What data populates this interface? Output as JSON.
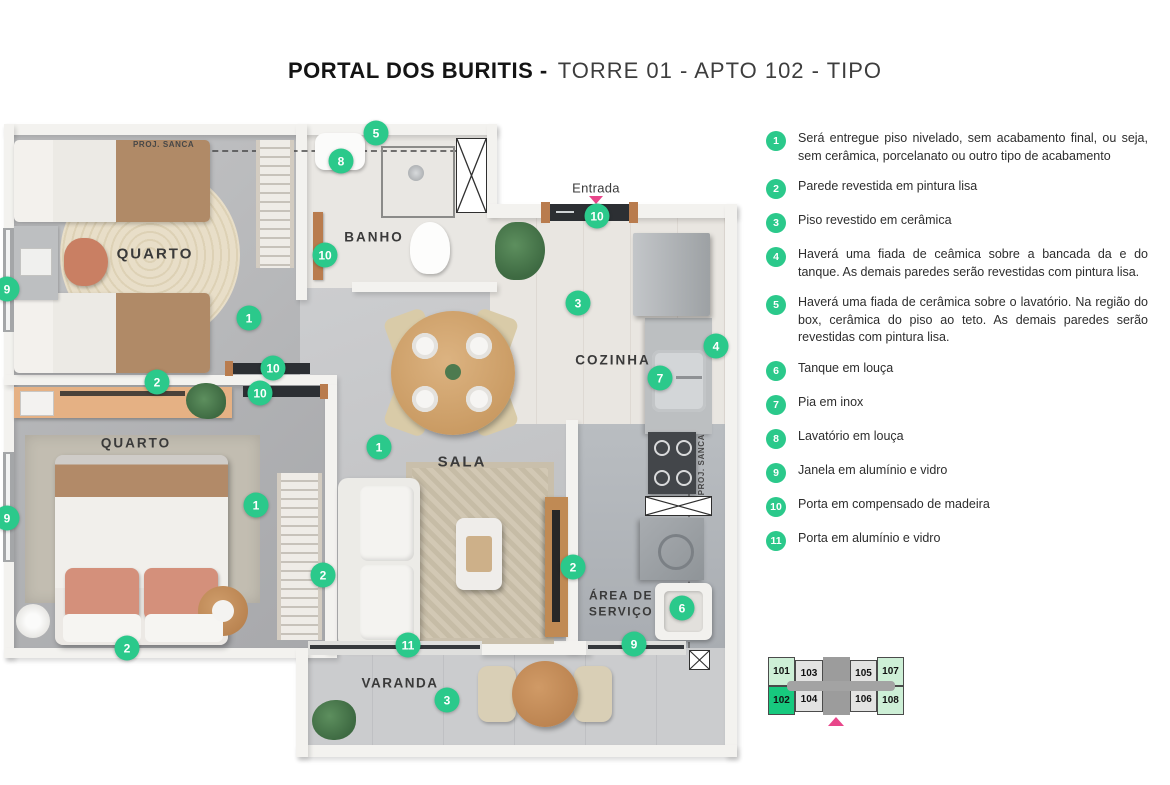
{
  "title": {
    "main": "PORTAL DOS BURITIS -",
    "sub": "TORRE 01 - APTO 102 - TIPO"
  },
  "legend": {
    "items": [
      {
        "num": "1",
        "text": "Será entregue piso nivelado, sem acabamento final, ou seja, sem cerâmica, porcelanato ou outro tipo de acabamento"
      },
      {
        "num": "2",
        "text": "Parede revestida em pintura lisa"
      },
      {
        "num": "3",
        "text": "Piso revestido em cerâmica"
      },
      {
        "num": "4",
        "text": "Haverá uma fiada de ceâmica sobre a bancada da e do tanque. As demais paredes serão revestidas com pintura lisa."
      },
      {
        "num": "5",
        "text": "Haverá uma fiada de cerâmica sobre o lavatório. Na região do box, cerâmica do piso ao teto. As demais paredes serão revestidas com pintura lisa."
      },
      {
        "num": "6",
        "text": "Tanque em louça"
      },
      {
        "num": "7",
        "text": "Pia em inox"
      },
      {
        "num": "8",
        "text": "Lavatório em louça"
      },
      {
        "num": "9",
        "text": "Janela em alumínio e vidro"
      },
      {
        "num": "10",
        "text": "Porta em compensado de madeira"
      },
      {
        "num": "11",
        "text": "Porta em alumínio e vidro"
      }
    ]
  },
  "plan": {
    "labels": {
      "quarto1": "QUARTO",
      "banho": "BANHO",
      "cozinha": "COZINHA",
      "quarto2": "QUARTO",
      "sala": "SALA",
      "area_servico": "ÁREA DE SERVIÇO",
      "varanda": "VARANDA",
      "entrada": "Entrada",
      "proj_sanca_top": "PROJ. SANCA",
      "proj_sanca_right": "PROJ. SANCA"
    },
    "markers": [
      {
        "n": "5",
        "x": 376,
        "y": 133
      },
      {
        "n": "8",
        "x": 341,
        "y": 161
      },
      {
        "n": "10",
        "x": 325,
        "y": 255
      },
      {
        "n": "10",
        "x": 597,
        "y": 216
      },
      {
        "n": "3",
        "x": 578,
        "y": 303
      },
      {
        "n": "4",
        "x": 716,
        "y": 346
      },
      {
        "n": "7",
        "x": 660,
        "y": 378
      },
      {
        "n": "9",
        "x": 7,
        "y": 289
      },
      {
        "n": "1",
        "x": 249,
        "y": 318
      },
      {
        "n": "10",
        "x": 273,
        "y": 368
      },
      {
        "n": "2",
        "x": 157,
        "y": 382
      },
      {
        "n": "10",
        "x": 260,
        "y": 393
      },
      {
        "n": "1",
        "x": 379,
        "y": 447
      },
      {
        "n": "9",
        "x": 7,
        "y": 518
      },
      {
        "n": "1",
        "x": 256,
        "y": 505
      },
      {
        "n": "2",
        "x": 323,
        "y": 575
      },
      {
        "n": "2",
        "x": 573,
        "y": 567
      },
      {
        "n": "6",
        "x": 682,
        "y": 608
      },
      {
        "n": "2",
        "x": 127,
        "y": 648
      },
      {
        "n": "11",
        "x": 408,
        "y": 645
      },
      {
        "n": "9",
        "x": 634,
        "y": 644
      },
      {
        "n": "3",
        "x": 447,
        "y": 700
      }
    ]
  },
  "keyplan": {
    "rows": [
      [
        {
          "label": "101",
          "state": "light"
        },
        {
          "label": "103",
          "state": "gray"
        },
        {
          "label": "105",
          "state": "gray"
        },
        {
          "label": "107",
          "state": "light"
        }
      ],
      [
        {
          "label": "102",
          "state": "selected"
        },
        {
          "label": "104",
          "state": "gray"
        },
        {
          "label": "106",
          "state": "gray"
        },
        {
          "label": "108",
          "state": "light"
        }
      ]
    ]
  },
  "colors": {
    "marker_green": "#2bc98b",
    "selected_green": "#17c97e",
    "light_green": "#cdefd6",
    "accent_pink": "#e8468a"
  }
}
